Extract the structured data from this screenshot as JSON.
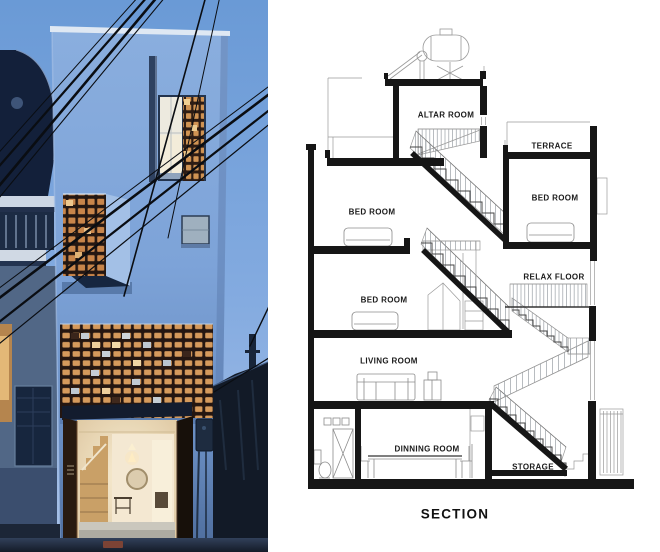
{
  "photo": {
    "colors": {
      "sky_top": "#6a9ad6",
      "sky_bottom": "#a9c2e8",
      "facade_blue": "#7da3d8",
      "brick_screen_warm": "#d59a5c",
      "interior_glow": "#f2e7d0",
      "door_dark_brown": "#281a10"
    }
  },
  "section": {
    "title": "SECTION",
    "rooms": {
      "altar": "ALTAR ROOM",
      "terrace": "TERRACE",
      "bed_top_left": "BED ROOM",
      "bed_right": "BED ROOM",
      "bed_mid_left": "BED ROOM",
      "relax": "RELAX FLOOR",
      "living": "LIVING ROOM",
      "dinning": "DINNING ROOM",
      "storage": "STORAGE"
    }
  }
}
